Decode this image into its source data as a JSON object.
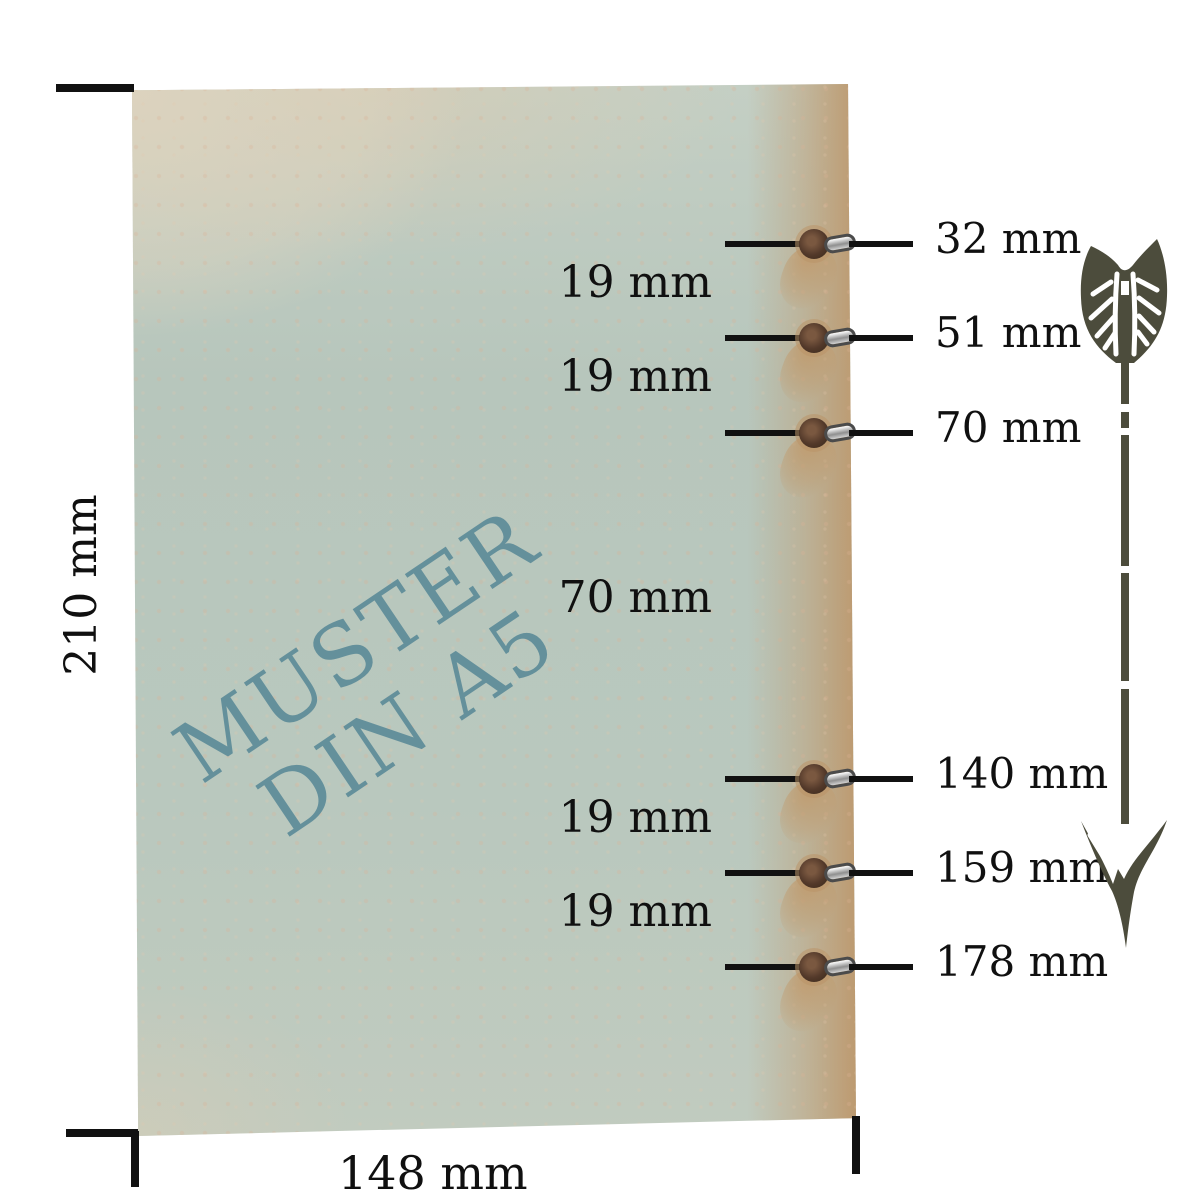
{
  "paper": {
    "watermark_line1": "MUSTER",
    "watermark_line2": "DIN A5",
    "watermark_color": "#64909b",
    "base_color": "#b8c6bc",
    "kraft_edge_color": "#bd9a70"
  },
  "dimensions": {
    "height_label": "210 mm",
    "width_label": "148 mm"
  },
  "holes": [
    {
      "mm": 32,
      "label": "32 mm"
    },
    {
      "mm": 51,
      "label": "51 mm"
    },
    {
      "mm": 70,
      "label": "70 mm"
    },
    {
      "mm": 140,
      "label": "140 mm"
    },
    {
      "mm": 159,
      "label": "159 mm"
    },
    {
      "mm": 178,
      "label": "178 mm"
    }
  ],
  "gaps": [
    {
      "label": "19 mm"
    },
    {
      "label": "19 mm"
    },
    {
      "label": "70 mm"
    },
    {
      "label": "19 mm"
    },
    {
      "label": "19 mm"
    }
  ],
  "arrow": {
    "color": "#4c4c3c"
  },
  "line_color": "#111111"
}
